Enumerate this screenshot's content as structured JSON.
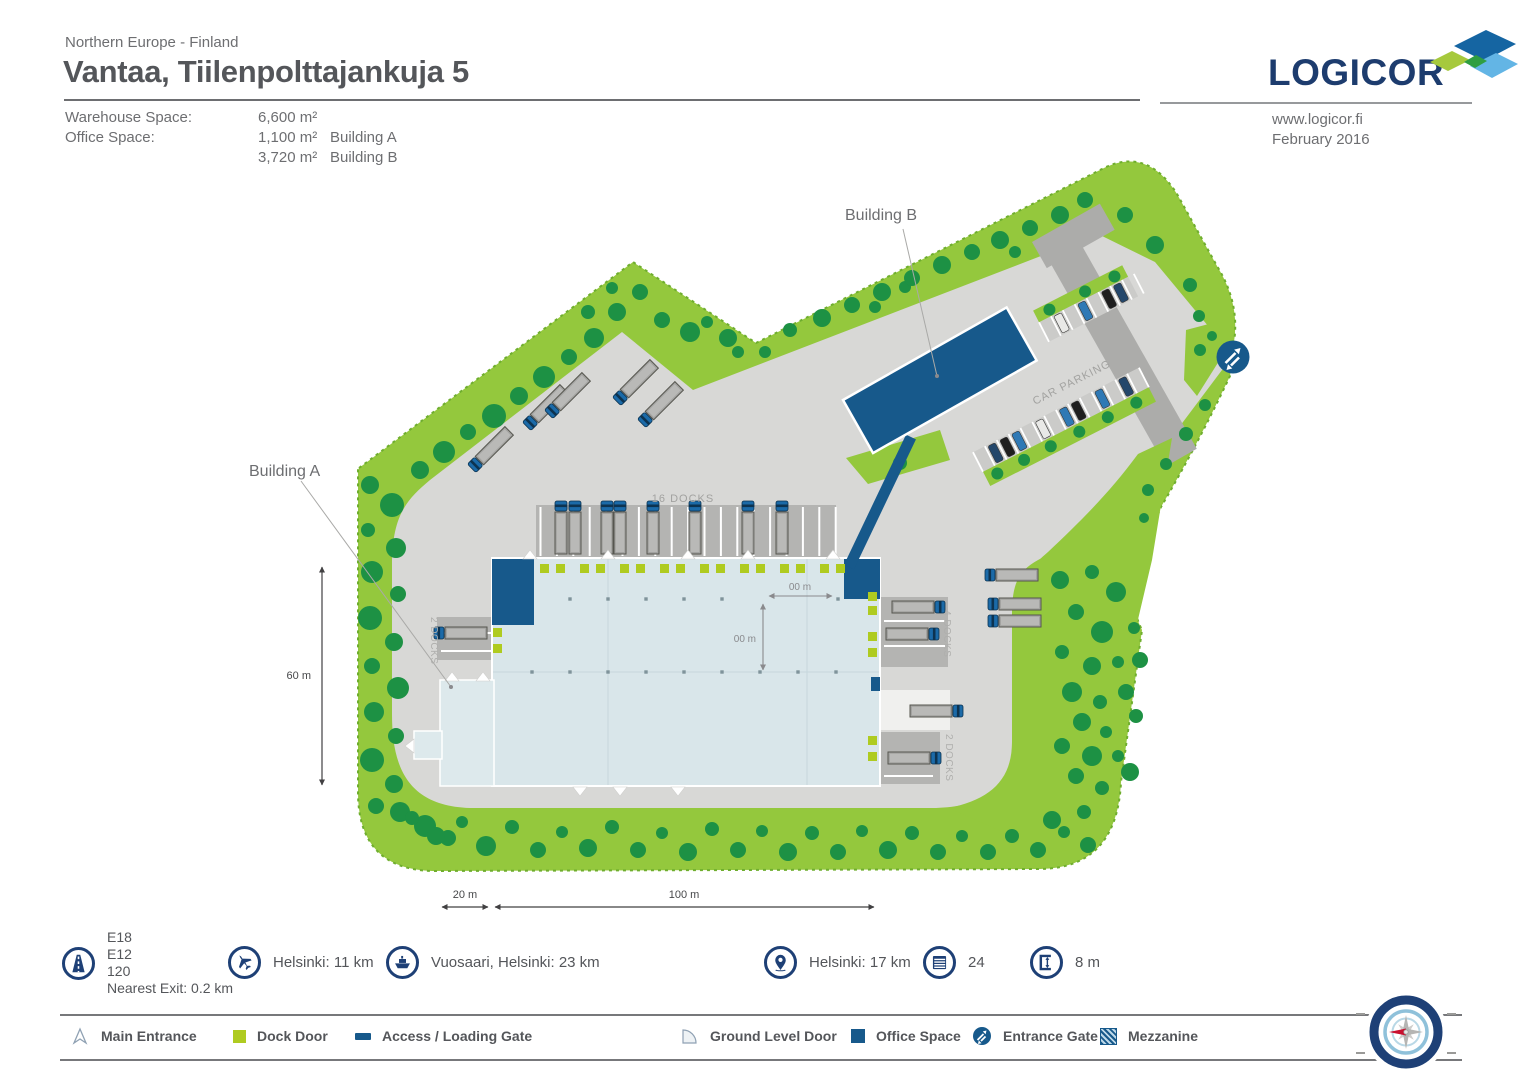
{
  "header": {
    "region": "Northern Europe - Finland",
    "title": "Vantaa, Tiilenpolttajankuja 5",
    "specs": {
      "warehouse_label": "Warehouse Space:",
      "warehouse_value": "6,600 m²",
      "office_label": "Office Space:",
      "office_a_value": "1,100 m²",
      "office_a_building": "Building A",
      "office_b_value": "3,720 m²",
      "office_b_building": "Building B"
    },
    "logo_text": "LOGICOR",
    "website": "www.logicor.fi",
    "date": "February 2016"
  },
  "map": {
    "building_a_label": "Building A",
    "building_b_label": "Building B",
    "docks_top_label": "16 DOCKS",
    "docks_left_label": "2 DOCKS",
    "docks_right_upper_label": "4 DOCKS",
    "docks_right_lower_label": "2 DOCKS",
    "car_parking_label": "CAR PARKING",
    "dim_grid_width": "00 m",
    "dim_grid_depth": "00 m",
    "dim_site_height": "60 m",
    "dim_site_annex": "20 m",
    "dim_site_width": "100 m"
  },
  "info": {
    "motorway": {
      "roads": [
        "E18",
        "E12",
        "120"
      ],
      "exit": "Nearest Exit: 0.2 km"
    },
    "airport": "Helsinki:  11 km",
    "port": "Vuosaari, Helsinki: 23 km",
    "city": "Helsinki: 17 km",
    "dock_doors": "24",
    "clear_height": "8 m"
  },
  "legend": [
    {
      "icon": "main-entrance-icon",
      "label": "Main Entrance"
    },
    {
      "icon": "dock-door-icon",
      "label": "Dock Door"
    },
    {
      "icon": "access-loading-gate-icon",
      "label": "Access / Loading Gate"
    },
    {
      "icon": "ground-level-door-icon",
      "label": "Ground Level Door"
    },
    {
      "icon": "office-space-icon",
      "label": "Office Space"
    },
    {
      "icon": "entrance-gate-icon",
      "label": "Entrance Gate"
    },
    {
      "icon": "mezzanine-icon",
      "label": "Mezzanine"
    }
  ],
  "colors": {
    "brand_navy": "#1d3c6e",
    "building_blue": "#17598b",
    "site_green": "#94c83d",
    "tree_green": "#1d9144",
    "dock_door_green": "#afcb20",
    "yard_gray": "#d8d8d6",
    "logo_light_blue": "#63b5e5",
    "logo_lime": "#a6c93c",
    "logo_mid_green": "#2f9e41",
    "compass_red": "#c8102e"
  }
}
